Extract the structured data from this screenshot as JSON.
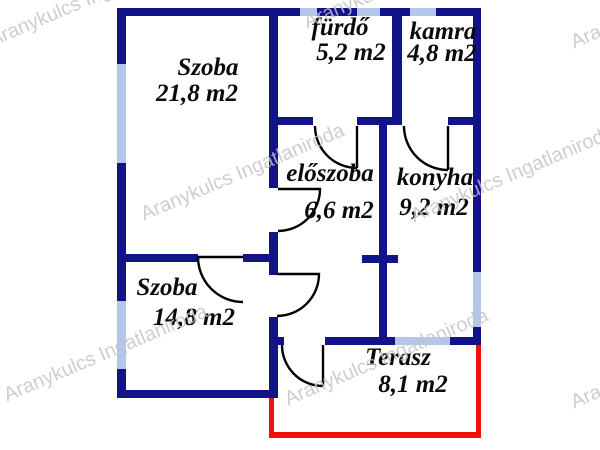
{
  "watermark": {
    "text": "Aranykulcs Ingatlaniroda"
  },
  "colors": {
    "wall": "#131389",
    "window": "#b3c7ec",
    "terrace_outline": "#ee1111",
    "door_line": "#000000",
    "room_label": "#0a0a0a",
    "watermark": "#c4c4c8"
  },
  "rooms": [
    {
      "name": "Szoba",
      "area": "21,8 m2"
    },
    {
      "name": "fürdő",
      "area": "5,2 m2"
    },
    {
      "name": "kamra",
      "area": "4,8 m2"
    },
    {
      "name": "előszoba",
      "area": "6,6 m2"
    },
    {
      "name": "konyha",
      "area": "9,2 m2"
    },
    {
      "name": "Szoba",
      "area": "14,8 m2"
    },
    {
      "name": "Terasz",
      "area": "8,1 m2"
    }
  ]
}
